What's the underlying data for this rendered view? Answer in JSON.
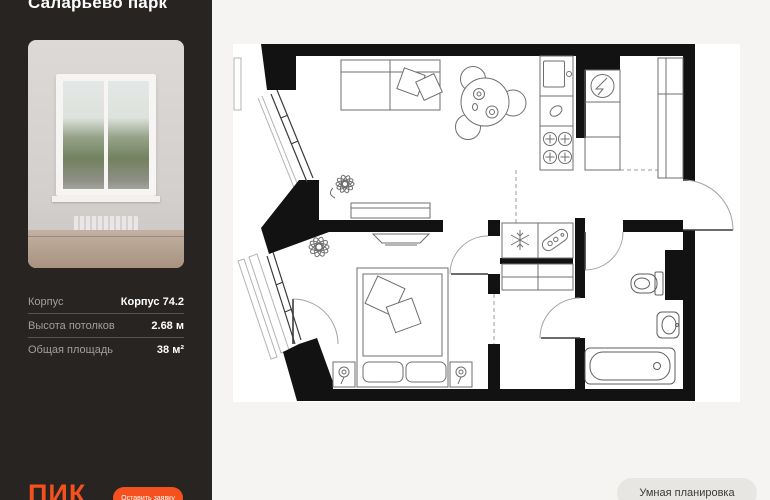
{
  "sidebar": {
    "title": "Саларьево парк",
    "photo": "room-with-window-photo",
    "details": [
      {
        "label": "Корпус",
        "value": "Корпус 74.2"
      },
      {
        "label": "Высота потолков",
        "value": "2.68 м"
      },
      {
        "label": "Общая площадь",
        "value": "38 м²"
      }
    ],
    "logo": "ПИК",
    "cta_label": "Оставить заявку"
  },
  "main": {
    "smart_layout_label": "Умная планировка"
  },
  "colors": {
    "sidebar_bg": "#272422",
    "accent_orange": "#f4511e",
    "main_bg": "#f5f4f2",
    "plan_bg": "#ffffff"
  },
  "floorplan": {
    "icons": [
      "sofa-icon",
      "pillows-icon",
      "plant-icon",
      "dining-table-icon",
      "chair-icon",
      "kitchen-sink-icon",
      "stove-icon",
      "fridge-icon",
      "kitchen-cabinet-icon",
      "wardrobe-icon",
      "snowflake-icon",
      "ironing-board-icon",
      "tv-icon",
      "console-icon",
      "bed-icon",
      "nightstand-lamp-icon",
      "toilet-icon",
      "bath-sink-icon",
      "bathtub-icon",
      "entry-door-icon",
      "interior-door-icon",
      "balcony-door-icon",
      "window-glazing-icon",
      "zone-dashed-line"
    ]
  }
}
